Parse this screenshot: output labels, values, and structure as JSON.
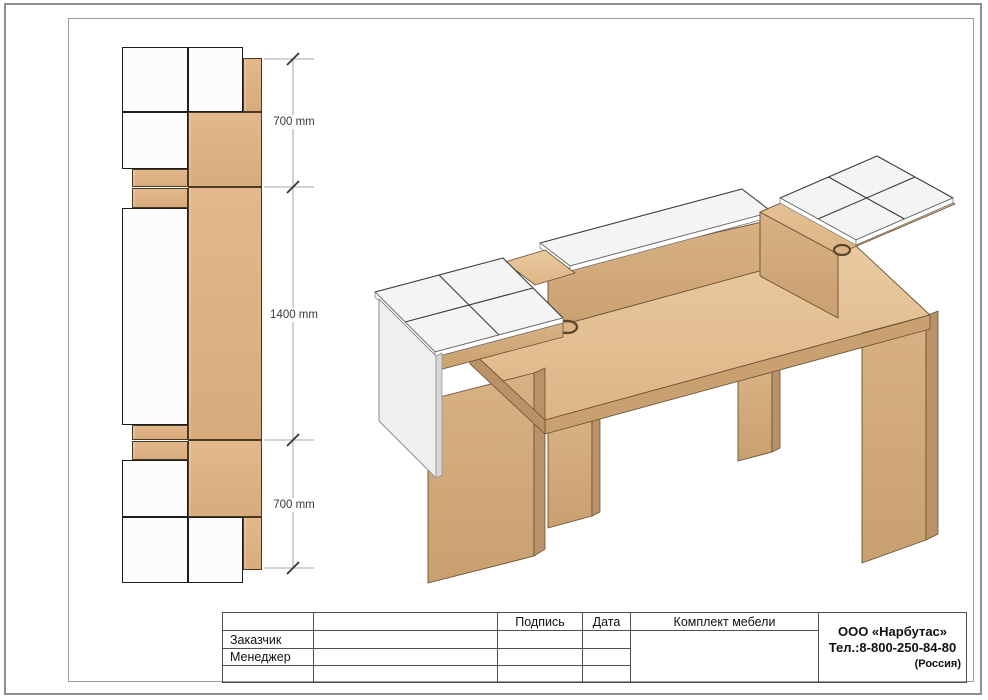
{
  "page": {
    "background": "#ffffff",
    "outer_border_color": "#8f8f8f",
    "inner_frame_color": "#9c9c9c"
  },
  "plan_view": {
    "dim_labels": [
      "700 mm",
      "1400 mm",
      "700 mm"
    ],
    "colors": {
      "wood": "#ddb084",
      "white_top": "#fcfcfc",
      "outline": "#1d1d1d",
      "dim_line": "#a6a6a6",
      "dim_tick": "#333333",
      "dim_text": "#3a3a3a"
    }
  },
  "iso_view": {
    "colors": {
      "wood_top": "#e4c197",
      "wood_front": "#d2a97c",
      "wood_side": "#bb9268",
      "white_top": "#f4f4f4",
      "white_panel": "#efefef",
      "outline": "#5f4930"
    }
  },
  "title_block": {
    "col_signature": "Подпись",
    "col_date": "Дата",
    "col_set": "Комплект мебели",
    "row_customer": "Заказчик",
    "row_manager": "Менеджер",
    "company_name": "ООО «Нарбутас»",
    "company_phone": "Тел.:8-800-250-84-80",
    "company_country": "(Россия)"
  }
}
